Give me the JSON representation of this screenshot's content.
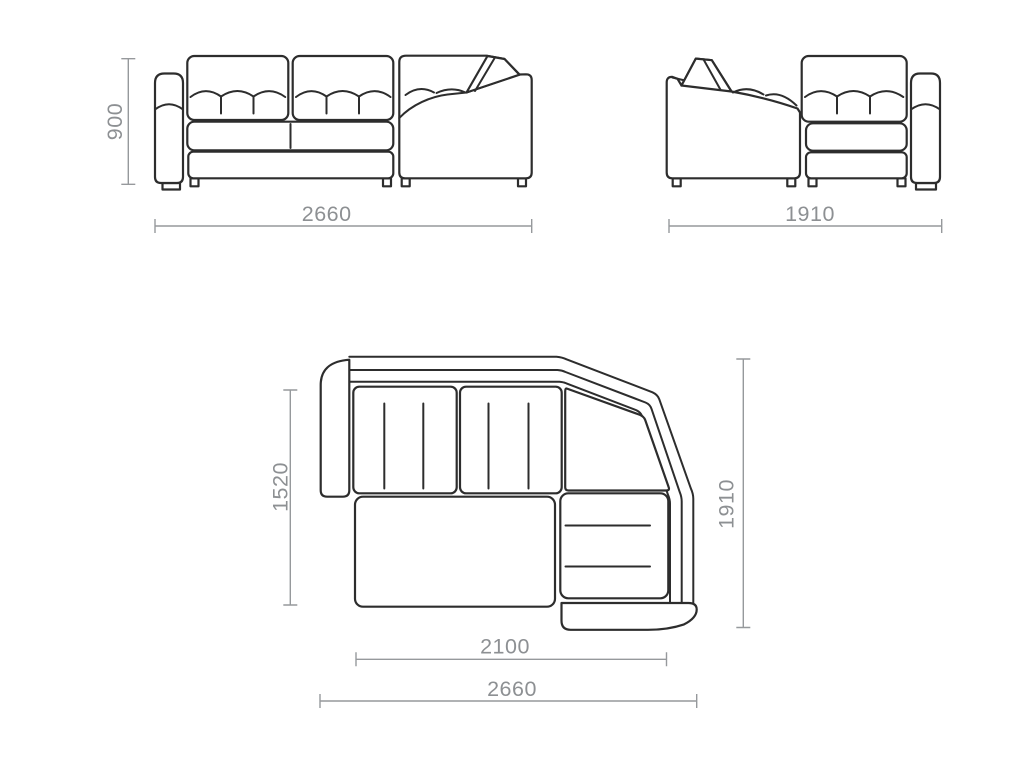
{
  "dimensions": {
    "front_height": "900",
    "front_width": "2660",
    "side_width": "1910",
    "plan_depth_left": "1520",
    "plan_depth_right": "1910",
    "plan_seat_width": "2100",
    "plan_total_width": "2660"
  },
  "colors": {
    "outline": "#2d2d2d",
    "dim-line": "#96999c",
    "dim-text": "#8d9093",
    "bg": "#ffffff"
  }
}
